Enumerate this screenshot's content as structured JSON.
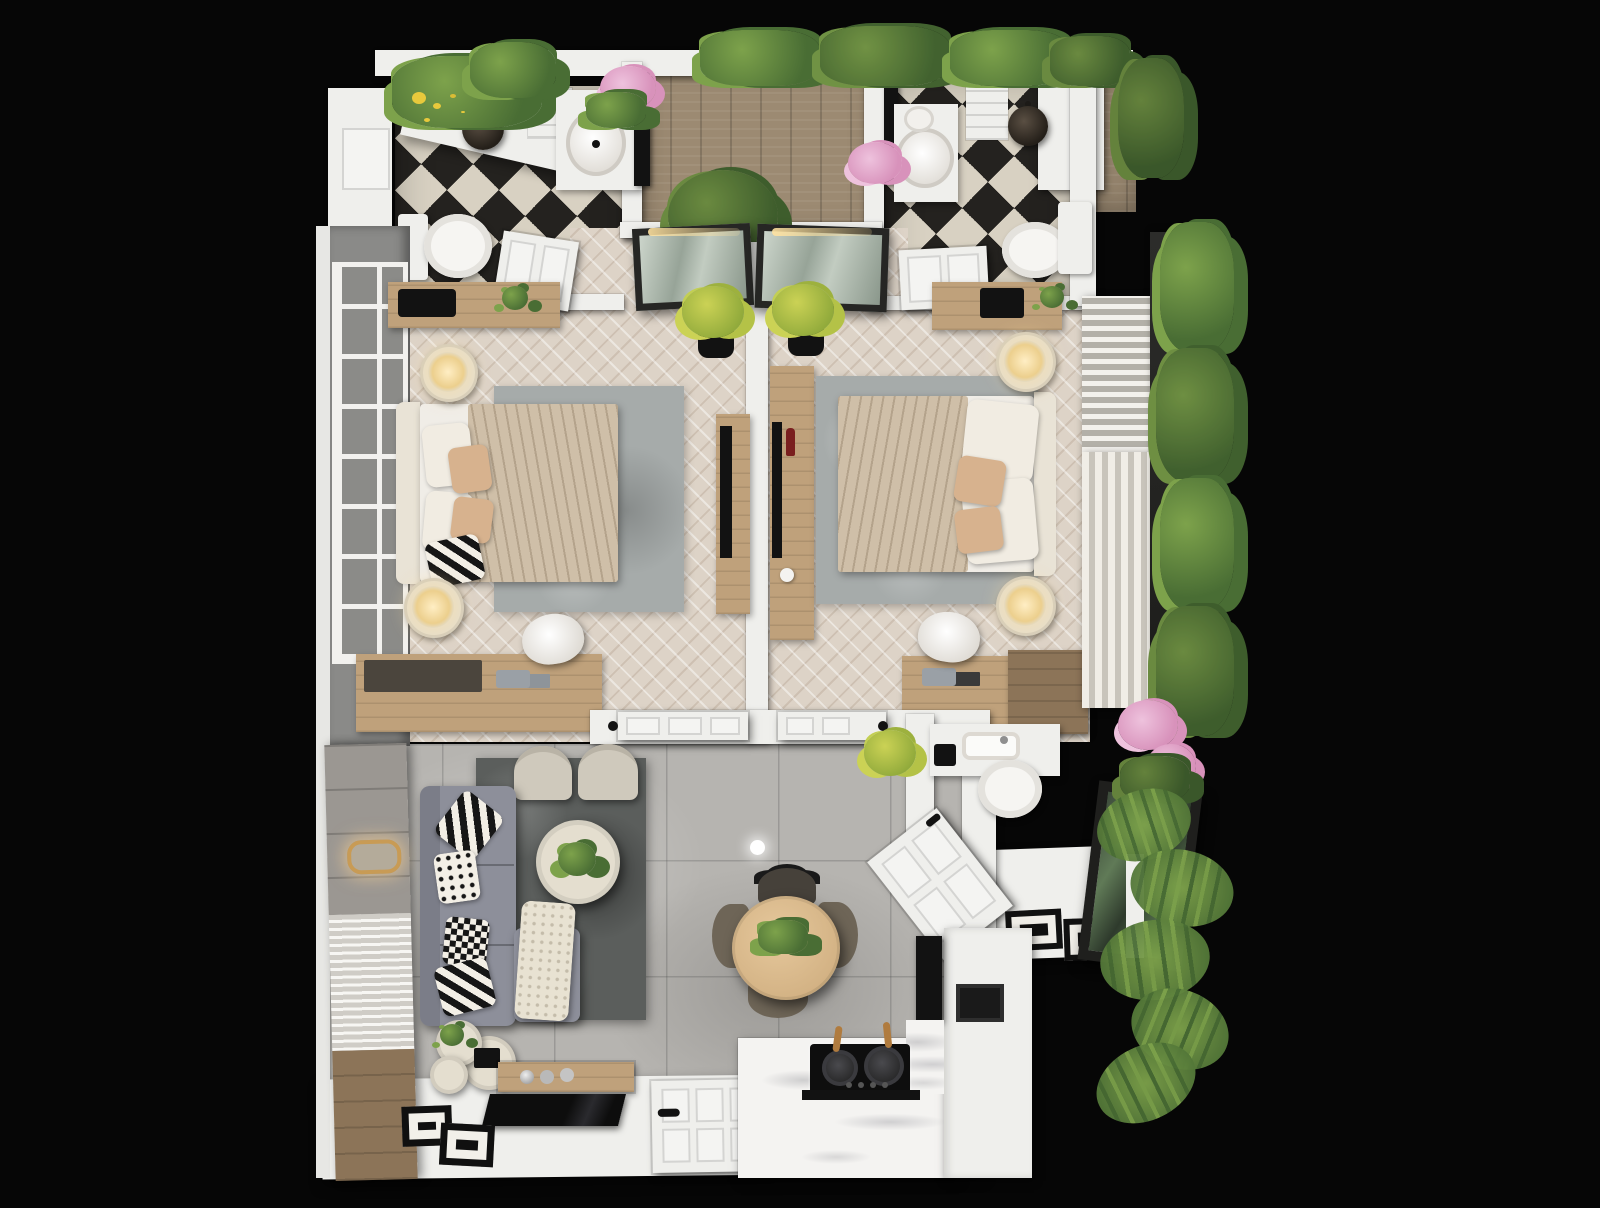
{
  "meta": {
    "title": "Top-down 3D render — two-bedroom apartment floor plan at night",
    "render_style": "photorealistic dollhouse view on black backdrop",
    "visible_text": "none"
  },
  "palette": {
    "bg": "#060606",
    "wall": "#efefec",
    "wall-grey": "#8a8a88",
    "tile-light": "#d8d1c2",
    "tile-dark": "#24221f",
    "wood-deck": "#9c8a72",
    "wood-furn": "#bfa17b",
    "wood-dark": "#8c7458",
    "floor-bedroom": "#ddd3c7",
    "floor-living": "#b6b4b0",
    "rug-grey": "#a6abaa",
    "rug-dark": "#5b5e5c",
    "sofa": "#8d8f9a",
    "sofa-dark": "#7b7d88",
    "cream": "#e4decf",
    "glow": "#ffeec4",
    "gold": "#c89b55",
    "green": "#496d34",
    "green-light": "#7da24b",
    "yellow-green": "#cbd255",
    "pink": "#d892bb",
    "pink-light": "#eec2dd",
    "glass-grey": "#8b8b88",
    "frame-dark": "#262624",
    "duvet": "#cfbfa8",
    "sheet": "#f0ede7",
    "accent-pillow": "#d7b28e",
    "black": "#121212",
    "wine-red": "#7a1f1f"
  },
  "rooms": [
    {
      "id": "bathroom-left",
      "label": "Bathroom 1",
      "floor": "black-white checkered tile",
      "fixtures": [
        "toilet",
        "round vessel sink vanity",
        "mirror",
        "pendant light",
        "shower bench",
        "planter with yellow flowers"
      ]
    },
    {
      "id": "terrace-deck",
      "label": "Terrace deck",
      "floor": "wood planks",
      "fixtures": [
        "tree planter",
        "perimeter greenery"
      ]
    },
    {
      "id": "bathroom-right",
      "label": "Bathroom 2",
      "floor": "black-white checkered tile",
      "fixtures": [
        "toilet",
        "round vessel sink vanity",
        "mirror",
        "pendant light",
        "white closet"
      ]
    },
    {
      "id": "bedroom-left",
      "label": "Bedroom 1",
      "floor": "chevron parquet",
      "fixtures": [
        "double bed",
        "two nightstand lamps",
        "grey rug",
        "desk with chair",
        "dresser",
        "TV console",
        "grid window wall",
        "glass door to deck",
        "potted plant"
      ]
    },
    {
      "id": "bedroom-right",
      "label": "Bedroom 2",
      "floor": "chevron parquet",
      "fixtures": [
        "double bed",
        "two nightstand lamps",
        "grey rug",
        "desk with chair",
        "dresser",
        "TV console",
        "curtain window wall",
        "glass door to deck",
        "potted plant"
      ]
    },
    {
      "id": "hallway",
      "label": "Hallway",
      "floor": "white",
      "fixtures": [
        "two open flat doors"
      ]
    },
    {
      "id": "living-room",
      "label": "Living room",
      "floor": "large grey tiles",
      "fixtures": [
        "L-shaped grey sofa",
        "two cream armchairs",
        "round coffee table",
        "dark rug",
        "nesting side tables",
        "slatted feature wall with gold sconce",
        "flat TV",
        "wood tray",
        "picture frames"
      ]
    },
    {
      "id": "dining-area",
      "label": "Dining area",
      "floor": "large grey tiles",
      "fixtures": [
        "round wood table",
        "four dark chairs",
        "ceiling light"
      ]
    },
    {
      "id": "kitchen",
      "label": "Kitchen",
      "floor": "white",
      "fixtures": [
        "L-shaped counter",
        "black cooktop with two pans",
        "black oven",
        "tall black appliance",
        "marble backsplash"
      ]
    },
    {
      "id": "wc",
      "label": "Guest WC",
      "floor": "grey tile",
      "fixtures": [
        "toilet",
        "vanity with sink",
        "potted plant"
      ]
    },
    {
      "id": "entry",
      "label": "Entry",
      "floor": "white",
      "fixtures": [
        "angled open entry door",
        "two dark floor mats",
        "leaning glazed panel"
      ]
    },
    {
      "id": "garden-edge",
      "label": "Perimeter planting",
      "fixtures": [
        "hedges",
        "palms",
        "pink flowers",
        "lavender"
      ]
    }
  ]
}
